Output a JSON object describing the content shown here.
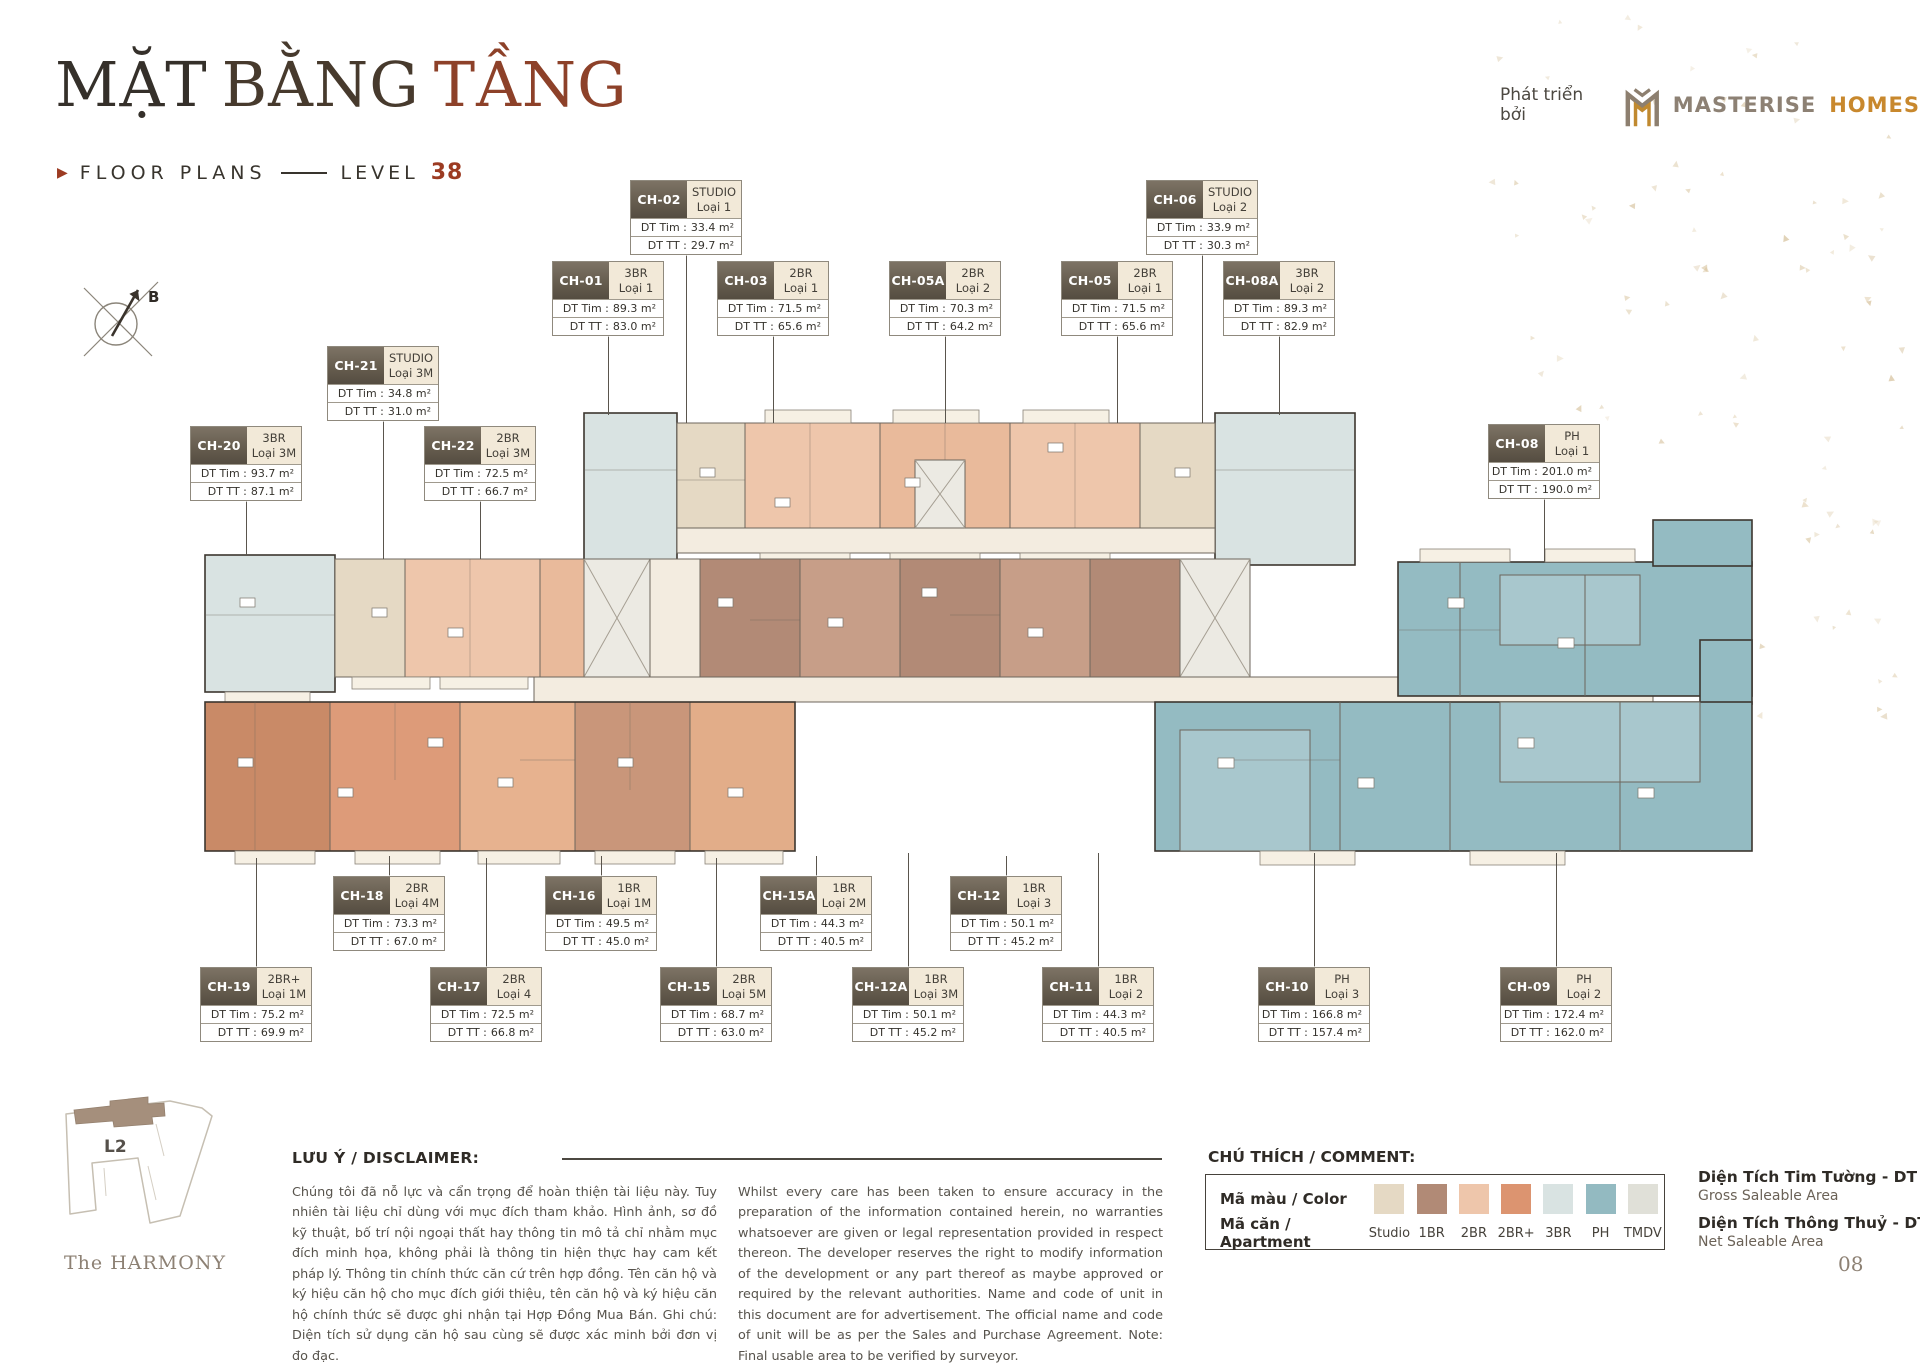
{
  "header": {
    "title_parts": [
      "MẶT",
      "BẰNG",
      "TẦNG"
    ],
    "subtitle": "FLOOR PLANS",
    "level_label": "LEVEL",
    "level_number": "38"
  },
  "brand": {
    "prefix": "Phát triển bởi",
    "name_primary": "MASTERISE",
    "name_secondary": "HOMES"
  },
  "compass": {
    "label": "B"
  },
  "units_meta": {
    "tim_label": "DT Tim",
    "tt_label": "DT TT",
    "separator": ":"
  },
  "units": [
    {
      "code": "CH-02",
      "type": "STUDIO",
      "variant": "Loại 1",
      "tim": "33.4 m²",
      "tt": "29.7 m²",
      "x": 630,
      "y": 180,
      "conn": [
        686,
        250,
        423
      ]
    },
    {
      "code": "CH-06",
      "type": "STUDIO",
      "variant": "Loại 2",
      "tim": "33.9 m²",
      "tt": "30.3 m²",
      "x": 1146,
      "y": 180,
      "conn": [
        1202,
        250,
        423
      ]
    },
    {
      "code": "CH-01",
      "type": "3BR",
      "variant": "Loại 1",
      "tim": "89.3 m²",
      "tt": "83.0 m²",
      "x": 552,
      "y": 261,
      "conn": [
        608,
        331,
        415
      ]
    },
    {
      "code": "CH-03",
      "type": "2BR",
      "variant": "Loại 1",
      "tim": "71.5 m²",
      "tt": "65.6 m²",
      "x": 717,
      "y": 261,
      "conn": [
        773,
        331,
        423
      ]
    },
    {
      "code": "CH-05A",
      "type": "2BR",
      "variant": "Loại 2",
      "tim": "70.3 m²",
      "tt": "64.2 m²",
      "x": 889,
      "y": 261,
      "conn": [
        945,
        331,
        423
      ]
    },
    {
      "code": "CH-05",
      "type": "2BR",
      "variant": "Loại 1",
      "tim": "71.5 m²",
      "tt": "65.6 m²",
      "x": 1061,
      "y": 261,
      "conn": [
        1117,
        331,
        423
      ]
    },
    {
      "code": "CH-08A",
      "type": "3BR",
      "variant": "Loại 2",
      "tim": "89.3 m²",
      "tt": "82.9 m²",
      "x": 1223,
      "y": 261,
      "conn": [
        1279,
        331,
        415
      ]
    },
    {
      "code": "CH-21",
      "type": "STUDIO",
      "variant": "Loại 3M",
      "tim": "34.8 m²",
      "tt": "31.0 m²",
      "x": 327,
      "y": 346,
      "conn": [
        383,
        416,
        559
      ]
    },
    {
      "code": "CH-20",
      "type": "3BR",
      "variant": "Loại 3M",
      "tim": "93.7 m²",
      "tt": "87.1 m²",
      "x": 190,
      "y": 426,
      "conn": [
        246,
        496,
        555
      ]
    },
    {
      "code": "CH-22",
      "type": "2BR",
      "variant": "Loại 3M",
      "tim": "72.5 m²",
      "tt": "66.7 m²",
      "x": 424,
      "y": 426,
      "conn": [
        480,
        496,
        559
      ]
    },
    {
      "code": "CH-08",
      "type": "PH",
      "variant": "Loại 1",
      "tim": "201.0 m²",
      "tt": "190.0 m²",
      "x": 1488,
      "y": 424,
      "conn": [
        1544,
        494,
        562
      ]
    },
    {
      "code": "CH-18",
      "type": "2BR",
      "variant": "Loại 4M",
      "tim": "73.3 m²",
      "tt": "67.0 m²",
      "x": 333,
      "y": 876,
      "conn": [
        389,
        856,
        876
      ]
    },
    {
      "code": "CH-16",
      "type": "1BR",
      "variant": "Loại 1M",
      "tim": "49.5 m²",
      "tt": "45.0 m²",
      "x": 545,
      "y": 876,
      "conn": [
        601,
        856,
        876
      ]
    },
    {
      "code": "CH-15A",
      "type": "1BR",
      "variant": "Loại 2M",
      "tim": "44.3 m²",
      "tt": "40.5 m²",
      "x": 760,
      "y": 876,
      "conn": [
        816,
        856,
        876
      ]
    },
    {
      "code": "CH-12",
      "type": "1BR",
      "variant": "Loại 3",
      "tim": "50.1 m²",
      "tt": "45.2 m²",
      "x": 950,
      "y": 876,
      "conn": [
        1006,
        856,
        876
      ]
    },
    {
      "code": "CH-19",
      "type": "2BR+",
      "variant": "Loại 1M",
      "tim": "75.2 m²",
      "tt": "69.9 m²",
      "x": 200,
      "y": 967,
      "conn": [
        256,
        858,
        967
      ]
    },
    {
      "code": "CH-17",
      "type": "2BR",
      "variant": "Loại 4",
      "tim": "72.5 m²",
      "tt": "66.8 m²",
      "x": 430,
      "y": 967,
      "conn": [
        486,
        858,
        967
      ]
    },
    {
      "code": "CH-15",
      "type": "2BR",
      "variant": "Loại 5M",
      "tim": "68.7 m²",
      "tt": "63.0 m²",
      "x": 660,
      "y": 967,
      "conn": [
        716,
        858,
        967
      ]
    },
    {
      "code": "CH-12A",
      "type": "1BR",
      "variant": "Loại 3M",
      "tim": "50.1 m²",
      "tt": "45.2 m²",
      "x": 852,
      "y": 967,
      "conn": [
        908,
        853,
        967
      ]
    },
    {
      "code": "CH-11",
      "type": "1BR",
      "variant": "Loại 2",
      "tim": "44.3 m²",
      "tt": "40.5 m²",
      "x": 1042,
      "y": 967,
      "conn": [
        1098,
        853,
        967
      ]
    },
    {
      "code": "CH-10",
      "type": "PH",
      "variant": "Loại 3",
      "tim": "166.8 m²",
      "tt": "157.4 m²",
      "x": 1258,
      "y": 967,
      "conn": [
        1314,
        853,
        967
      ]
    },
    {
      "code": "CH-09",
      "type": "PH",
      "variant": "Loại 2",
      "tim": "172.4 m²",
      "tt": "162.0 m²",
      "x": 1500,
      "y": 967,
      "conn": [
        1556,
        853,
        967
      ]
    }
  ],
  "legend": {
    "title": "CHÚ THÍCH / COMMENT:",
    "color_row_label": "Mã màu / Color",
    "apartment_row_label": "Mã căn / Apartment",
    "items": [
      {
        "label": "Studio",
        "color": "#e5d9c4"
      },
      {
        "label": "1BR",
        "color": "#b18a76"
      },
      {
        "label": "2BR",
        "color": "#eec6ab"
      },
      {
        "label": "2BR+",
        "color": "#dc9470"
      },
      {
        "label": "3BR",
        "color": "#d9e3e2"
      },
      {
        "label": "PH",
        "color": "#93bac1"
      },
      {
        "label": "TMDV",
        "color": "#e0e0d8"
      }
    ]
  },
  "area_definitions": [
    {
      "title": "Diện Tích Tim Tường - DT Tim",
      "subtitle": "Gross Saleable Area"
    },
    {
      "title": "Diện Tích Thông Thuỷ - DT TT",
      "subtitle": "Net Saleable Area"
    }
  ],
  "disclaimer": {
    "heading": "LƯU Ý / DISCLAIMER:",
    "vietnamese": "Chúng tôi đã nỗ lực và cẩn trọng để hoàn thiện tài liệu này. Tuy nhiên tài liệu chỉ dùng với mục đích tham khảo. Hình ảnh, sơ đồ kỹ thuật, bố trí nội ngoại thất hay thông tin mô tả chỉ nhằm mục đích minh họa, không phải là thông tin hiện thực hay cam kết pháp lý. Thông tin chính thức căn cứ trên hợp đồng. Tên căn hộ và ký hiệu căn hộ cho mục đích giới thiệu, tên căn hộ và ký hiệu căn hộ chính thức sẽ được ghi nhận tại Hợp Đồng Mua Bán. Ghi chú: Diện tích sử dụng căn hộ sau cùng sẽ được xác minh bởi đơn vị đo đạc.",
    "english": "Whilst every care has been taken to ensure accuracy in the preparation of the information contained herein, no warranties whatsoever are given or legal representation provided in respect thereon. The developer reserves the right to modify information of the development or any part thereof as maybe approved or required by the relevant authorities. Name and code of unit in this document are for advertisement. The official name and code of unit will be as per the Sales and Purchase Agreement. Note: Final usable area to be verified by surveyor."
  },
  "sitemap": {
    "block_label": "L2",
    "project_name": "The HARMONY"
  },
  "page_number": "08"
}
